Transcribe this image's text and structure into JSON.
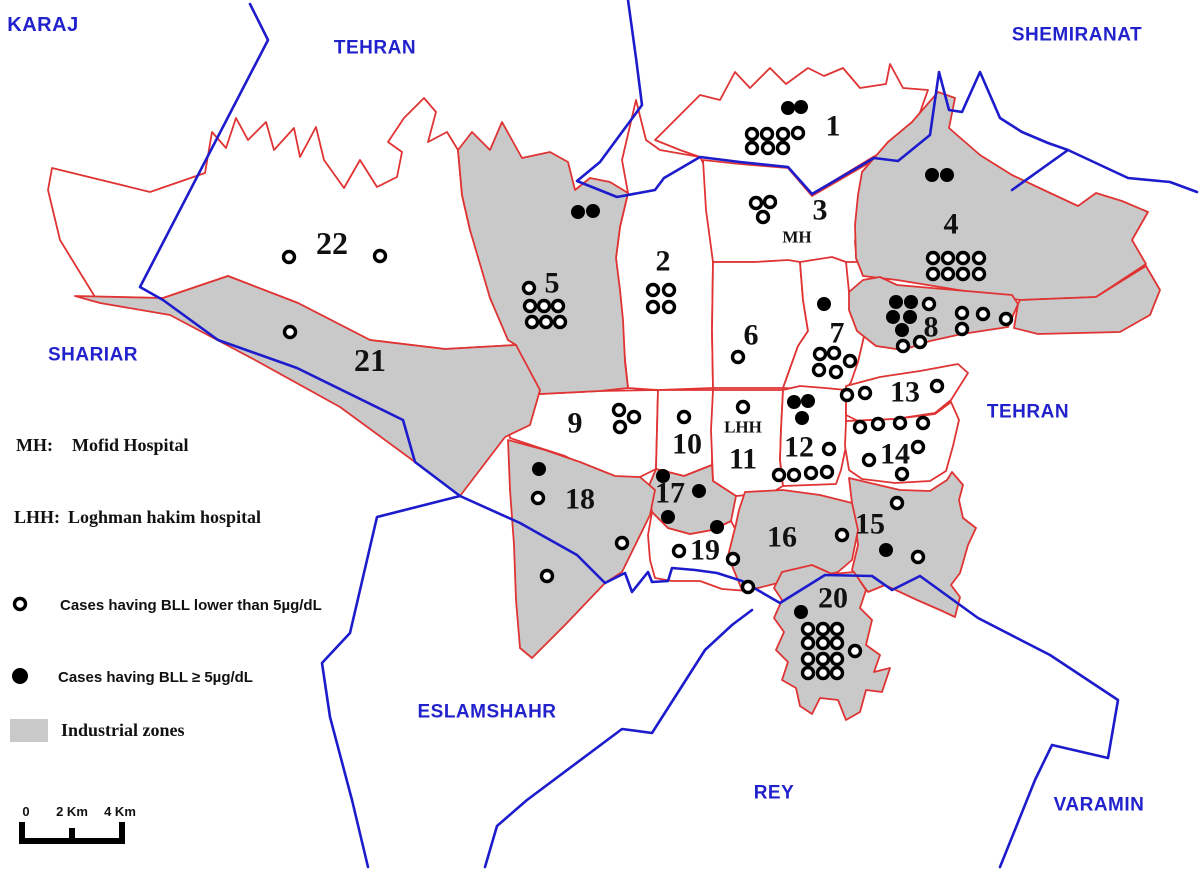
{
  "map": {
    "colors": {
      "district_border": "#e03333",
      "region_border": "#1c1ccc",
      "industrial_fill": "#c9c9c9",
      "district_fill": "#ffffff",
      "number_color": "#111111",
      "region_label_color": "#2222cc",
      "marker_color": "#000000"
    },
    "districts": [
      {
        "id": "1",
        "industrial": false,
        "label": [
          833,
          126
        ],
        "poly": "655,140 700,95 720,100 735,72 750,88 770,68 786,84 808,68 824,76 843,68 860,88 886,84 890,64 903,88 928,90 918,118 910,137 873,157 812,194 788,167 740,162 700,157 680,150",
        "high": [
          [
            788,
            108
          ],
          [
            801,
            107
          ]
        ],
        "low": [
          [
            752,
            134
          ],
          [
            767,
            134
          ],
          [
            783,
            134
          ],
          [
            798,
            133
          ],
          [
            752,
            148
          ],
          [
            768,
            148
          ],
          [
            783,
            148
          ]
        ]
      },
      {
        "id": "2",
        "industrial": false,
        "label": [
          663,
          261
        ],
        "poly": "636,100 646,140 660,150 700,157 712,180 713,262 712,330 713,388 658,390 628,388 624,350 620,300 616,258 620,227 628,193 622,160",
        "high": [],
        "low": [
          [
            653,
            290
          ],
          [
            669,
            290
          ],
          [
            653,
            307
          ],
          [
            669,
            307
          ]
        ]
      },
      {
        "id": "3",
        "industrial": false,
        "label": [
          820,
          210
        ],
        "sublabel": {
          "text": "MH",
          "pos": [
            797,
            237
          ],
          "name": "mh-hospital-label"
        },
        "poly": "703,160 740,164 788,168 812,196 874,160 901,143 916,128 924,136 900,162 875,177 862,182 858,215 855,242 857,262 800,262 755,262 713,262 706,210",
        "high": [],
        "low": [
          [
            756,
            203
          ],
          [
            770,
            202
          ],
          [
            763,
            217
          ]
        ]
      },
      {
        "id": "4",
        "industrial": true,
        "label": [
          951,
          224
        ],
        "poly": "862,172 888,142 912,122 938,92 955,98 949,128 980,155 1012,175 1048,192 1078,206 1096,193 1122,201 1148,212 1132,240 1146,264 1096,297 1020,300 940,287 897,280 863,276 856,258 855,225 858,195",
        "high": [
          [
            932,
            175
          ],
          [
            947,
            175
          ]
        ],
        "low": [
          [
            933,
            258
          ],
          [
            948,
            258
          ],
          [
            963,
            258
          ],
          [
            979,
            258
          ],
          [
            933,
            274
          ],
          [
            948,
            274
          ],
          [
            963,
            274
          ],
          [
            979,
            274
          ]
        ]
      },
      {
        "id": "5",
        "industrial": true,
        "label": [
          552,
          283
        ],
        "poly": "458,150 472,132 490,150 502,122 522,158 550,152 568,162 575,190 590,178 610,182 628,193 620,227 616,258 620,290 623,320 625,362 628,388 600,391 540,394 516,345 508,340 490,298 470,230 462,195",
        "high": [
          [
            578,
            212
          ],
          [
            593,
            211
          ]
        ],
        "low": [
          [
            529,
            288
          ],
          [
            530,
            306
          ],
          [
            544,
            306
          ],
          [
            558,
            306
          ],
          [
            532,
            322
          ],
          [
            546,
            322
          ],
          [
            560,
            322
          ]
        ]
      },
      {
        "id": "6",
        "industrial": false,
        "label": [
          751,
          335
        ],
        "poly": "713,262 755,262 788,260 800,262 803,300 808,331 798,346 783,388 713,388 712,330",
        "high": [],
        "low": [
          [
            738,
            357
          ]
        ]
      },
      {
        "id": "7",
        "industrial": false,
        "label": [
          837,
          333
        ],
        "poly": "800,262 832,257 846,262 849,292 858,310 865,332 858,362 851,382 846,390 783,388 798,346 808,331 803,300",
        "high": [
          [
            824,
            304
          ]
        ],
        "low": [
          [
            820,
            354
          ],
          [
            834,
            353
          ],
          [
            850,
            361
          ],
          [
            819,
            370
          ],
          [
            836,
            372
          ]
        ]
      },
      {
        "id": "8",
        "industrial": true,
        "label": [
          931,
          327
        ],
        "poly": "849,292 863,280 880,277 897,285 1012,295 1018,304 1008,327 962,334 930,341 903,350 876,346 857,331 849,310",
        "high": [
          [
            896,
            302
          ],
          [
            911,
            302
          ],
          [
            893,
            317
          ],
          [
            910,
            317
          ],
          [
            902,
            330
          ]
        ],
        "low": [
          [
            929,
            304
          ],
          [
            962,
            313
          ],
          [
            983,
            314
          ],
          [
            1006,
            319
          ],
          [
            962,
            329
          ],
          [
            903,
            346
          ],
          [
            920,
            342
          ]
        ]
      },
      {
        "id": "9",
        "industrial": false,
        "label": [
          575,
          423
        ],
        "poly": "503,402 540,394 600,391 658,390 656,469 640,477 620,478 590,469 565,456 540,448 510,438",
        "high": [],
        "low": [
          [
            619,
            410
          ],
          [
            634,
            417
          ],
          [
            620,
            427
          ]
        ]
      },
      {
        "id": "10",
        "industrial": false,
        "label": [
          687,
          444
        ],
        "poly": "658,390 713,390 712,465 684,476 656,469",
        "high": [],
        "low": [
          [
            684,
            417
          ]
        ]
      },
      {
        "id": "11",
        "industrial": false,
        "label": [
          743,
          459
        ],
        "sublabel": {
          "text": "LHH",
          "pos": [
            743,
            427
          ],
          "name": "lhh-hospital-label"
        },
        "poly": "713,390 783,390 781,430 780,460 783,486 771,493 736,496 713,481 711,430",
        "high": [],
        "low": [
          [
            743,
            407
          ]
        ]
      },
      {
        "id": "12",
        "industrial": false,
        "label": [
          799,
          447
        ],
        "poly": "783,390 800,386 825,388 846,390 846,415 846,446 841,470 836,484 783,486 780,460 781,430",
        "high": [
          [
            794,
            402
          ],
          [
            808,
            401
          ],
          [
            802,
            418
          ]
        ],
        "low": [
          [
            829,
            449
          ],
          [
            779,
            475
          ],
          [
            794,
            475
          ],
          [
            811,
            473
          ],
          [
            827,
            472
          ]
        ]
      },
      {
        "id": "13",
        "industrial": false,
        "label": [
          905,
          392
        ],
        "poly": "846,386 880,377 920,371 958,364 968,373 951,400 935,413 895,419 858,421 846,415",
        "high": [],
        "low": [
          [
            847,
            395
          ],
          [
            865,
            393
          ],
          [
            937,
            386
          ]
        ]
      },
      {
        "id": "14",
        "industrial": false,
        "label": [
          895,
          454
        ],
        "poly": "846,421 895,419 935,414 951,402 959,420 953,446 946,471 930,481 895,483 862,479 849,470 845,446",
        "high": [],
        "low": [
          [
            860,
            427
          ],
          [
            878,
            424
          ],
          [
            900,
            423
          ],
          [
            923,
            423
          ],
          [
            918,
            447
          ],
          [
            869,
            460
          ],
          [
            902,
            474
          ]
        ]
      },
      {
        "id": "15",
        "industrial": true,
        "label": [
          870,
          524
        ],
        "poly": "849,478 900,490 930,491 947,480 952,472 963,485 959,500 963,518 976,528 968,545 960,573 951,585 960,597 955,617 940,610 917,600 885,585 868,592 852,570 858,545 855,520 852,503",
        "high": [
          [
            886,
            550
          ]
        ],
        "low": [
          [
            897,
            503
          ],
          [
            842,
            535
          ],
          [
            918,
            557
          ]
        ]
      },
      {
        "id": "16",
        "industrial": true,
        "label": [
          782,
          537
        ],
        "poly": "745,492 783,490 820,495 852,503 858,530 852,560 838,572 825,575 790,580 758,588 742,590 728,556 736,524 739,510",
        "high": [],
        "low": []
      },
      {
        "id": "17",
        "industrial": true,
        "label": [
          670,
          493
        ],
        "poly": "656,469 684,476 712,465 713,481 736,496 731,521 712,530 690,534 668,528 652,512 648,488",
        "high": [
          [
            663,
            476
          ],
          [
            699,
            491
          ],
          [
            668,
            517
          ]
        ],
        "low": []
      },
      {
        "id": "18",
        "industrial": true,
        "label": [
          580,
          499
        ],
        "poly": "508,440 545,450 580,462 615,476 640,477 655,490 650,515 622,572 605,583 565,625 532,658 520,648 516,600 514,545 510,490",
        "high": [
          [
            539,
            469
          ]
        ],
        "low": [
          [
            538,
            498
          ],
          [
            622,
            543
          ],
          [
            547,
            576
          ]
        ]
      },
      {
        "id": "19",
        "industrial": false,
        "label": [
          705,
          550
        ],
        "poly": "652,512 668,528 690,534 712,530 731,521 739,536 751,553 759,573 748,591 722,589 700,581 672,581 655,578 650,560 648,535",
        "high": [
          [
            717,
            527
          ]
        ],
        "low": [
          [
            679,
            551
          ],
          [
            733,
            559
          ],
          [
            748,
            587
          ]
        ]
      },
      {
        "id": "20",
        "industrial": true,
        "label": [
          833,
          598
        ],
        "poly": "782,572 812,565 832,574 854,572 866,590 860,608 872,620 866,645 880,655 874,672 890,668 882,692 866,690 860,712 846,720 838,700 820,698 812,714 800,706 796,688 782,680 788,662 776,650 784,632 774,618 782,600 774,588",
        "high": [
          [
            801,
            612
          ]
        ],
        "low": [
          [
            808,
            629
          ],
          [
            823,
            629
          ],
          [
            837,
            629
          ],
          [
            808,
            643
          ],
          [
            823,
            643
          ],
          [
            837,
            643
          ],
          [
            808,
            659
          ],
          [
            823,
            659
          ],
          [
            837,
            659
          ],
          [
            855,
            651
          ],
          [
            808,
            673
          ],
          [
            823,
            673
          ],
          [
            837,
            673
          ]
        ]
      },
      {
        "id": "21",
        "industrial": true,
        "label": [
          370,
          360
        ],
        "label_size": 32,
        "poly": "75,296 163,298 228,276 298,303 370,340 445,349 516,345 540,390 530,425 505,437 460,496 415,462 340,407 255,360 170,315 100,303",
        "high": [],
        "low": [
          [
            290,
            332
          ]
        ]
      },
      {
        "id": "22",
        "industrial": false,
        "label": [
          332,
          243
        ],
        "label_size": 32,
        "poly": "52,168 150,192 205,173 212,132 226,148 236,118 248,140 266,122 274,150 294,128 300,157 316,127 324,160 344,188 360,160 377,187 397,177 402,152 388,142 404,118 424,98 436,112 428,142 447,132 458,150 462,195 470,230 480,260 490,298 500,320 508,340 516,345 445,349 370,340 298,303 228,276 163,298 95,297 60,240 48,190",
        "high": [],
        "low": [
          [
            289,
            257
          ],
          [
            380,
            256
          ]
        ]
      }
    ],
    "extra_zones": [
      {
        "poly": "1020,300 1096,297 1146,266 1160,290 1150,315 1120,332 1038,334 1014,328 1018,304"
      }
    ],
    "boundaries": [
      "250,4 268,40 140,287 163,300 218,340 297,368 403,420 415,462 460,496 520,523 577,555 605,583 625,573 632,592 648,572 652,582 668,581 672,568 695,570 717,573 742,581 780,603 825,575 872,576 892,590 920,576 978,618 1050,655 1118,700 1108,758 1052,745 1035,780 1000,867",
      "460,496 377,517 350,633 322,663 330,717 352,800 368,867",
      "485,867 497,826 527,800 622,729 652,733 705,650 732,625 752,610",
      "628,0 636,58 642,105 600,162 577,181 617,197 655,190 664,178 700,157 740,162 788,167 812,194 874,158 898,161 930,135 939,72 949,110 962,112 980,72 1000,118 1022,132 1048,143 1068,150 1012,190",
      "1068,150 1128,178 1170,182 1197,192"
    ],
    "region_labels": [
      {
        "text": "KARAJ",
        "x": 43,
        "y": 25,
        "size": 20
      },
      {
        "text": "TEHRAN",
        "x": 375,
        "y": 48,
        "size": 19
      },
      {
        "text": "SHEMIRANAT",
        "x": 1077,
        "y": 35,
        "size": 19
      },
      {
        "text": "SHARIAR",
        "x": 93,
        "y": 355,
        "size": 19
      },
      {
        "text": "TEHRAN",
        "x": 1028,
        "y": 412,
        "size": 19
      },
      {
        "text": "ESLAMSHAHR",
        "x": 487,
        "y": 712,
        "size": 19
      },
      {
        "text": "REY",
        "x": 774,
        "y": 793,
        "size": 19
      },
      {
        "text": "VARAMIN",
        "x": 1099,
        "y": 805,
        "size": 19
      }
    ]
  },
  "legend": {
    "mh_abbr": "MH:",
    "mh_name": "Mofid Hospital",
    "lhh_abbr": "LHH:",
    "lhh_name": "Loghman hakim hospital",
    "low_label": "Cases having BLL lower than 5µg/dL",
    "high_label": "Cases having BLL ≥ 5µg/dL",
    "industrial_label": "Industrial zones",
    "scale": {
      "t0": "0",
      "t2": "2 Km",
      "t4": "4 Km"
    }
  }
}
